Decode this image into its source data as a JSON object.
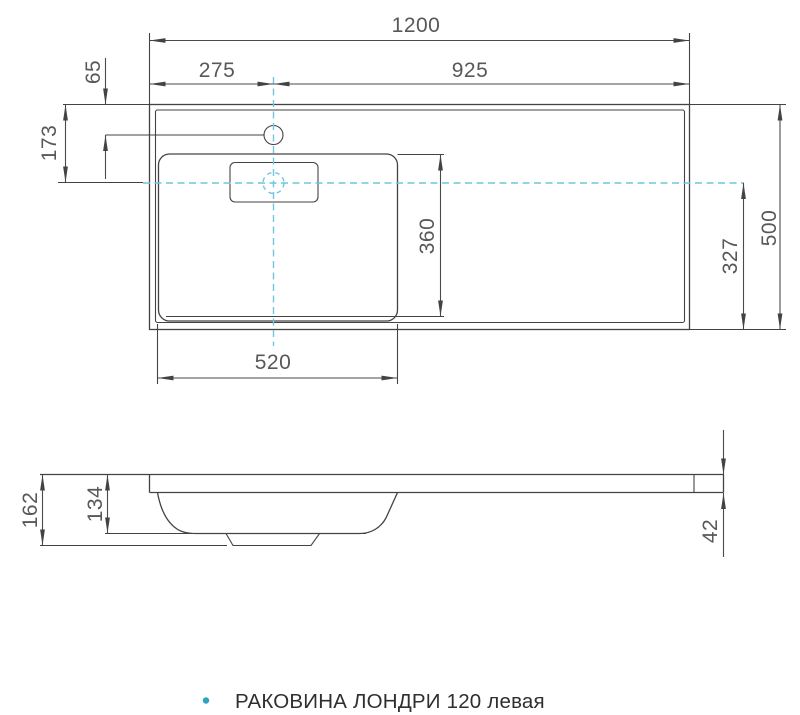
{
  "drawing": {
    "caption": "РАКОВИНА ЛОНДРИ 120 левая",
    "caption_bullet_color": "#2ea3bd",
    "line_color": "#434343",
    "dim_text_color": "#585858",
    "centerline_color": "#6fc6de",
    "top_view": {
      "overall_width": "1200",
      "faucet_offset_left": "275",
      "faucet_offset_right": "925",
      "faucet_from_back_edge": "65",
      "axis_from_back_edge": "173",
      "bowl_width": "360",
      "axis_from_front_edge": "327",
      "overall_depth": "500",
      "bowl_length": "520"
    },
    "side_view": {
      "overall_height": "162",
      "bowl_depth": "134",
      "worktop_thickness": "42"
    }
  }
}
